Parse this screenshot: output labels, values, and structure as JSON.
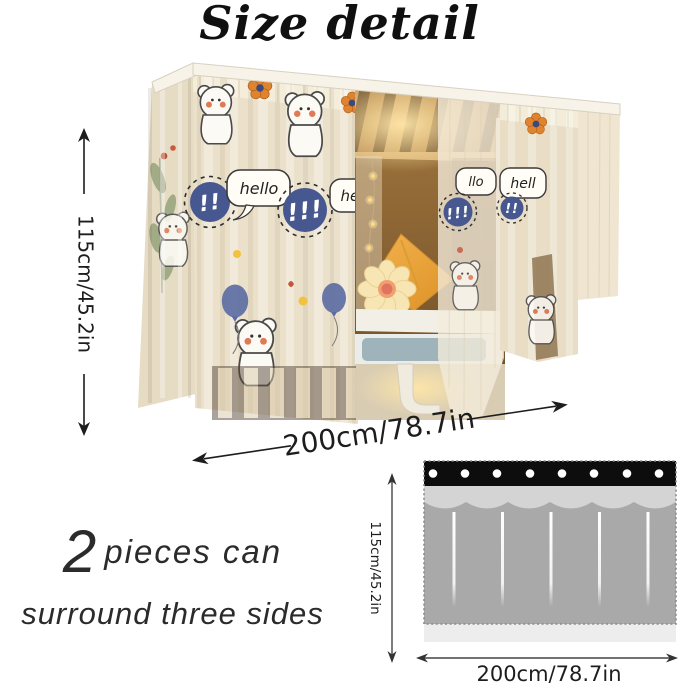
{
  "title": "Size detail",
  "photo": {
    "height_label": "115cm/45.2in",
    "width_label": "200cm/78.7in",
    "prints": {
      "bubble_hello": "hello",
      "bubble_hell": "hell",
      "bubble_llo": "llo",
      "badge_double": "!!",
      "badge_triple": "!!!"
    }
  },
  "note": {
    "quantity": "2",
    "line1": "pieces can",
    "line2": "surround three sides"
  },
  "diagram": {
    "height_label": "115cm/45.2in",
    "width_label": "200cm/78.7in"
  },
  "colors": {
    "badge_blue": "#47578f",
    "balloon_blue": "#5b6ba3",
    "pillow_orange": "#e8a23c",
    "curtain_cream": "#ebe0ca",
    "base_blue_gray": "#9fb4ba",
    "diagram_black": "#0d0d0d",
    "diagram_light_gray": "#d4d4d4",
    "diagram_dark_gray": "#a9a9a9"
  }
}
